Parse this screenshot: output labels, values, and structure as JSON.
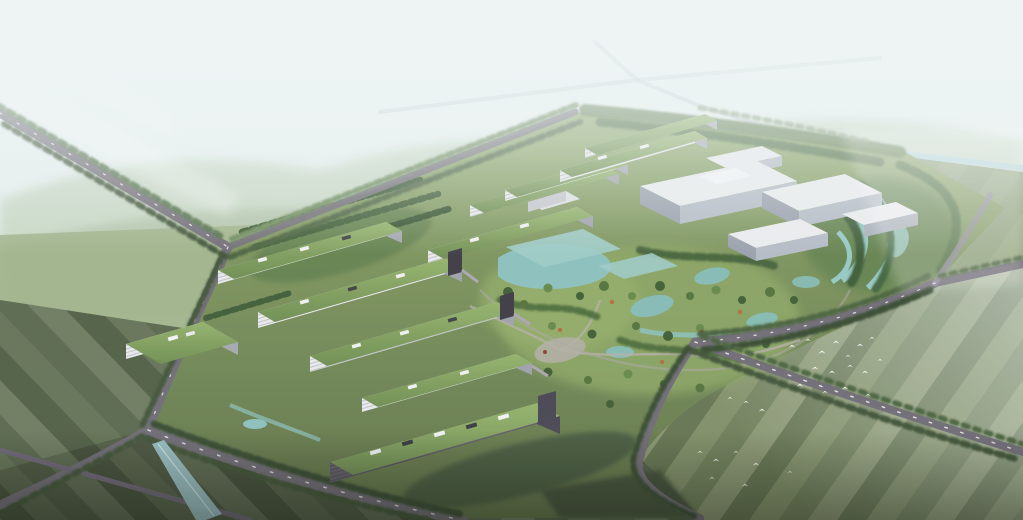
{
  "scene": {
    "type": "aerial architectural rendering",
    "description": "bird's-eye masterplan of a green research campus surrounded by tree-lined roads, canals and striped farmland",
    "regions": {
      "sky": "hazy white-blue sky",
      "hills": "distant hazy green hills",
      "campus": "central campus with green-roof slab buildings and white halls",
      "park": "central landscaped park with teal ponds and paths",
      "wetland": "east wetland garden with winding water channels",
      "fields_bottom_right": "striped farm fields with flock of white birds",
      "fields_bottom_left": "dark striped farm fields with drainage channel",
      "roads": "tree-lined perimeter and field roads",
      "canal": "irrigation canal at upper right"
    },
    "bird_flock_count": 26
  },
  "palette": {
    "sky_top": "#f0f6f7",
    "sky_horizon": "#e2eeec",
    "haze": "#eef5f5",
    "hills": "#b6c9ab",
    "hills_near": "#a3b897",
    "midground_green": "#9cb086",
    "field_br": [
      "#6d7d58",
      "#7e8d65",
      "#62724e",
      "#87946f"
    ],
    "field_bl": [
      "#525f46",
      "#5d6b4f",
      "#48553d",
      "#67755a"
    ],
    "campus_top": "#8aa465",
    "campus_bottom": "#5d7146",
    "road": "#6e6a74",
    "road_dark": "#5a5462",
    "road_distant": "#c2ccd0",
    "tree_dark": "#3e5134",
    "tree_mid": "#527040",
    "tree_hazy": "#7d9570",
    "water_canal": "#aed3d9",
    "water_pond": "#8ac0bd",
    "water_channel": "#9fc9cf",
    "roof_green_light": "#92b169",
    "roof_green": "#6c8b4e",
    "facade_white": "#e8e9eb",
    "facade_line": "#b9bdc4",
    "facade_shadow": "#5f5b66",
    "hall_top": "#e9ebee",
    "hall_side": "#b3bac4",
    "hall_side_dark": "#989fab",
    "path_gray": "#b3aea6",
    "bird": "#ffffff",
    "accent_autumn": "#b06a3a",
    "tower_dark": "#3a3741"
  }
}
